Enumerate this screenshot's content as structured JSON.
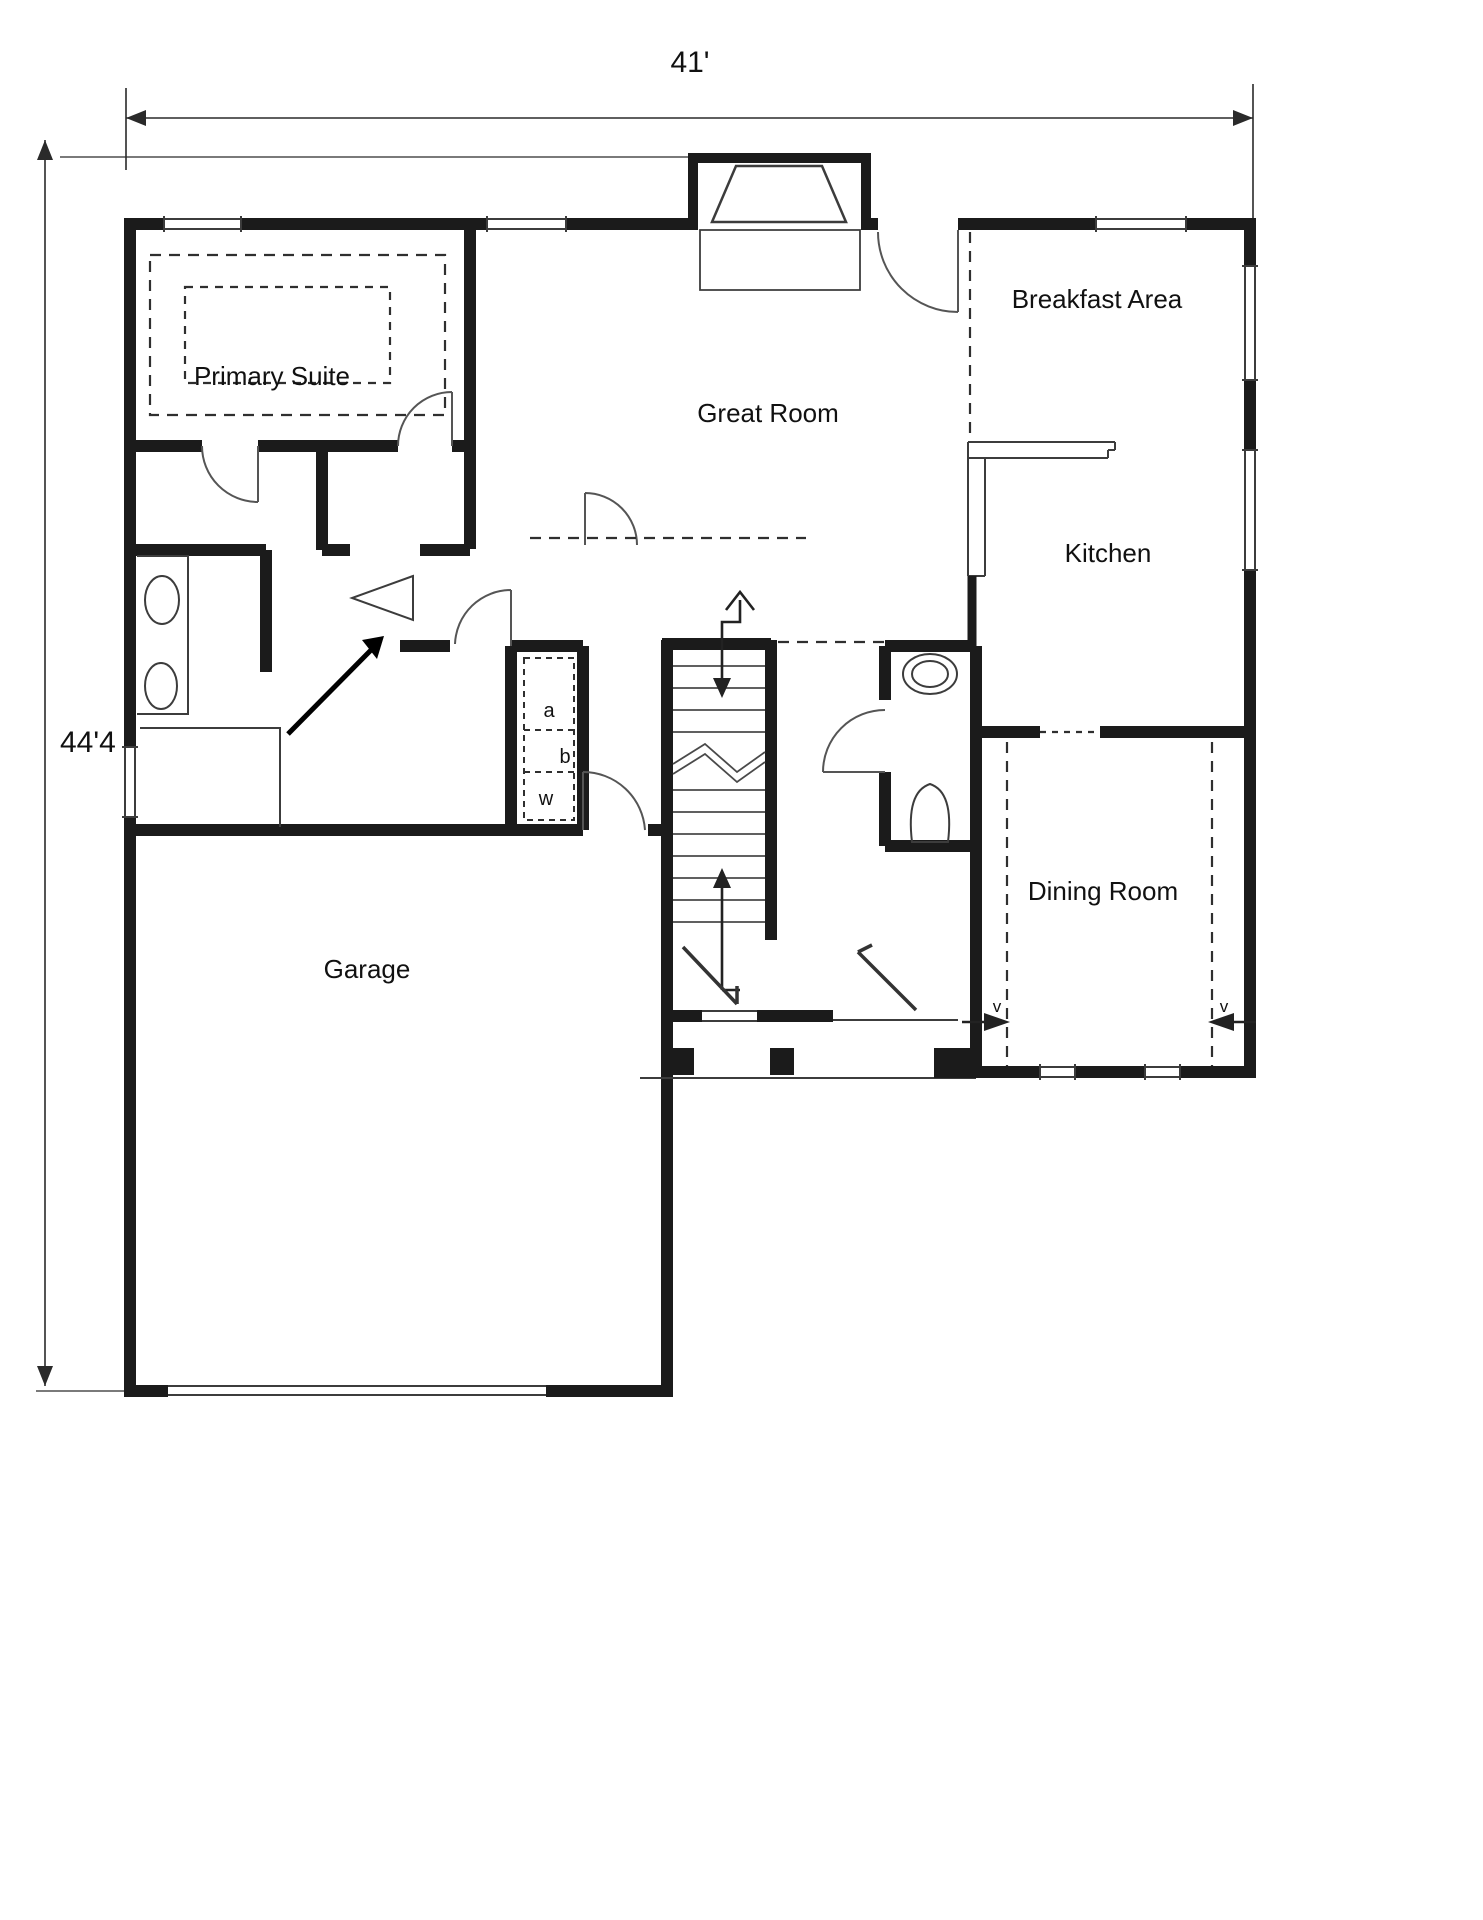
{
  "dimensions": {
    "width_label": "41'",
    "depth_label": "44'4"
  },
  "rooms": [
    {
      "id": "primary-suite",
      "label": "Primary Suite"
    },
    {
      "id": "great-room",
      "label": "Great Room"
    },
    {
      "id": "breakfast-area",
      "label": "Breakfast Area"
    },
    {
      "id": "kitchen",
      "label": "Kitchen"
    },
    {
      "id": "dining-room",
      "label": "Dining Room"
    },
    {
      "id": "garage",
      "label": "Garage"
    }
  ],
  "annotations": {
    "closet_a": "a",
    "closet_b": "b",
    "closet_w": "w",
    "vent_left": "v",
    "vent_right": "v"
  },
  "colors": {
    "wall": "#1b1b1b",
    "thin": "#3c3c3c",
    "dash": "#2f2f2f",
    "background": "#ffffff"
  }
}
